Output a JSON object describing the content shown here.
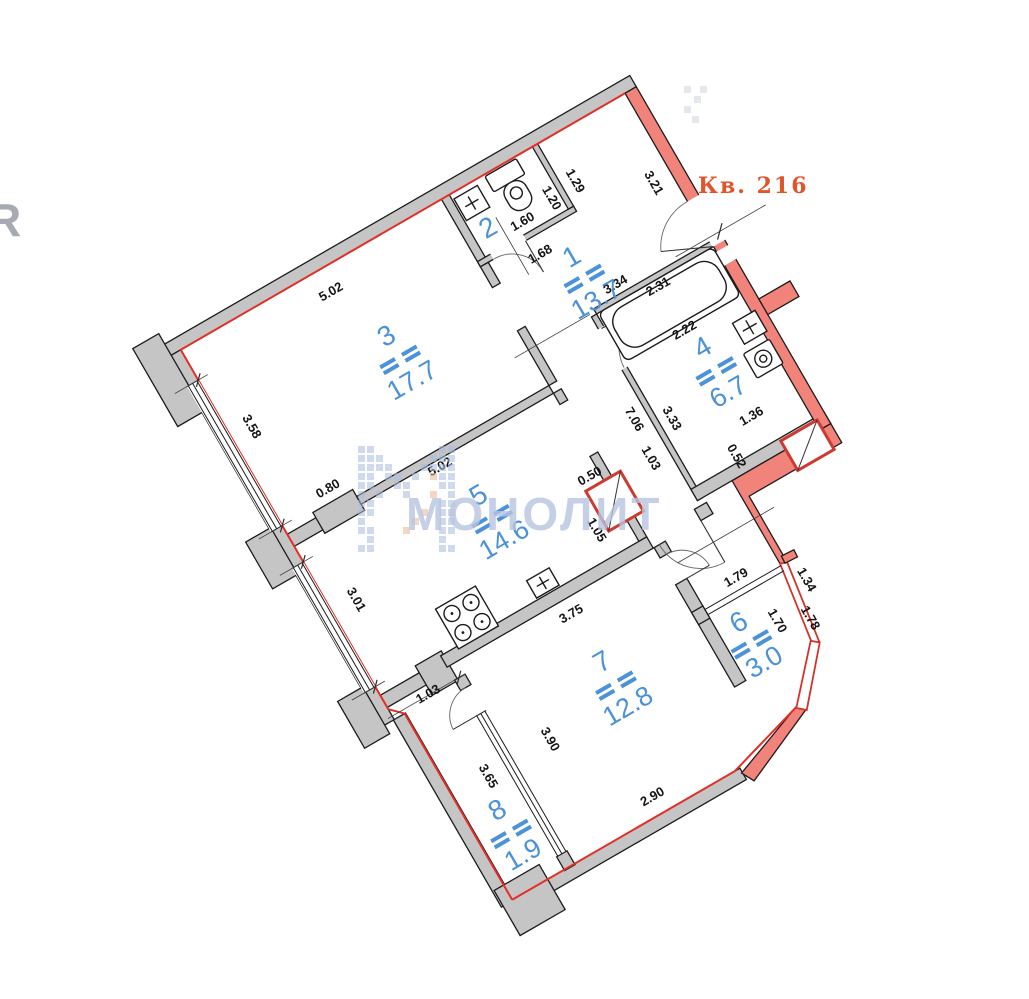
{
  "apartment": {
    "label": "Кв. 216",
    "label_color": "#e0562c"
  },
  "watermark": {
    "text": "МОНОЛИТ",
    "color": "#b7c5e0",
    "logo_blue": "#a9bedd",
    "logo_orange": "#eab895",
    "edge_letter": "R",
    "logo_pattern": [
      "11000000011",
      "11100000111",
      "11110001111",
      "11011010211",
      "11001100011",
      "10100100201",
      "11000000011",
      "11000002011",
      "10000020011",
      "11000200011",
      "01000000010",
      "11000000011"
    ]
  },
  "rooms": [
    {
      "number": "1",
      "area": "13.7"
    },
    {
      "number": "2",
      "area": ""
    },
    {
      "number": "3",
      "area": "17.7"
    },
    {
      "number": "4",
      "area": "6.7"
    },
    {
      "number": "5",
      "area": "14.6"
    },
    {
      "number": "6",
      "area": "3.0"
    },
    {
      "number": "7",
      "area": "12.8"
    },
    {
      "number": "8",
      "area": "1.9"
    }
  ],
  "dimensions": [
    {
      "value": "5.02"
    },
    {
      "value": "1.29"
    },
    {
      "value": "1.20"
    },
    {
      "value": "1.60"
    },
    {
      "value": "1.68"
    },
    {
      "value": "3.21"
    },
    {
      "value": "3.34"
    },
    {
      "value": "2.31"
    },
    {
      "value": "2.22"
    },
    {
      "value": "3.58"
    },
    {
      "value": "0.80"
    },
    {
      "value": "5.02"
    },
    {
      "value": "3.01"
    },
    {
      "value": "7.06"
    },
    {
      "value": "3.33"
    },
    {
      "value": "1.03"
    },
    {
      "value": "0.50"
    },
    {
      "value": "1.05"
    },
    {
      "value": "1.36"
    },
    {
      "value": "0.52"
    },
    {
      "value": "1.03"
    },
    {
      "value": "3.65"
    },
    {
      "value": "3.90"
    },
    {
      "value": "3.75"
    },
    {
      "value": "2.90"
    },
    {
      "value": "1.79"
    },
    {
      "value": "1.34"
    },
    {
      "value": "1.70"
    },
    {
      "value": "1.78"
    }
  ],
  "icons": [
    {
      "name": "toilet-icon"
    },
    {
      "name": "sink-icon"
    },
    {
      "name": "bathtub-icon"
    },
    {
      "name": "washing-machine-icon"
    },
    {
      "name": "stove-icon"
    },
    {
      "name": "electric-panel-icon"
    },
    {
      "name": "vent-shaft-icon"
    }
  ],
  "colors": {
    "wall_gray": "#c5c5c5",
    "wall_red": "#f2837b",
    "red_line": "#e03028",
    "room_label_blue": "#4b92d8",
    "dimension_text": "#141414"
  }
}
